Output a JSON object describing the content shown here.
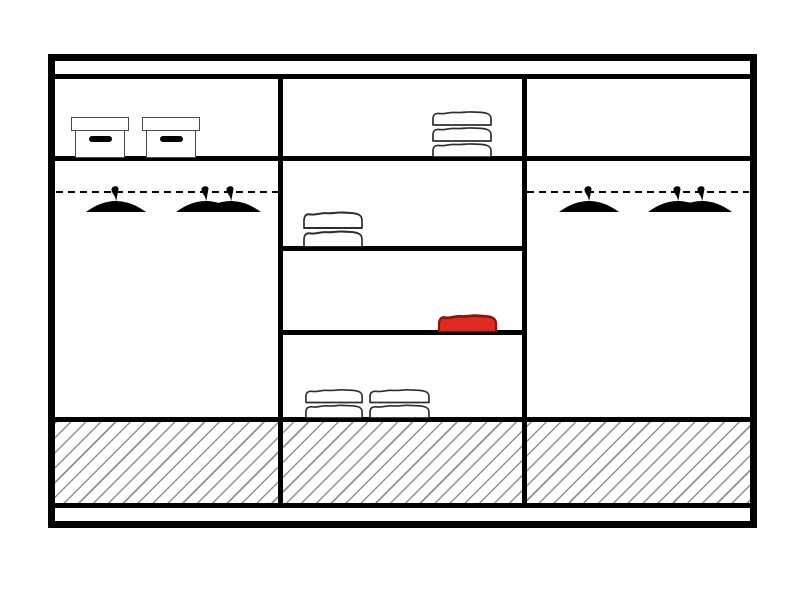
{
  "diagram": {
    "type": "wardrobe-interior-cross-section",
    "colors": {
      "outline": "#000000",
      "surface": "#ffffff",
      "item_outline": "#2e2e2e",
      "box_outline": "#4a4a4a",
      "hatch_line": "#909090",
      "red_fill": "#e02b22",
      "red_outline": "#8a150f"
    },
    "structure": {
      "sections": 3,
      "top_panel": true,
      "left_section": {
        "top_shelf_boxes": 2,
        "hanging_rail": "dashed",
        "hangers": 3
      },
      "middle_section": {
        "shelves": 4,
        "folded_stack_layers": [
          3,
          2,
          2,
          2
        ],
        "red_folded_items": 1
      },
      "right_section": {
        "top_shelf_boxes": 0,
        "hanging_rail": "dashed",
        "hangers": 3
      },
      "base": {
        "style": "diagonal-hatch",
        "spans_all_sections": true
      }
    }
  }
}
